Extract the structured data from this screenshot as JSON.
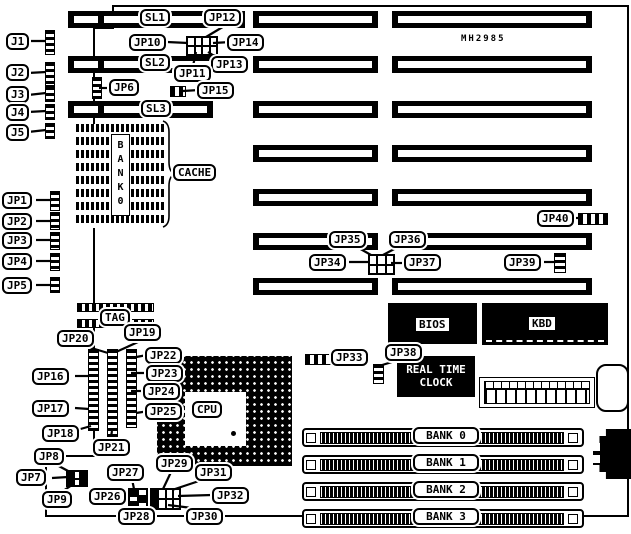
{
  "board": {
    "model": "MH2985"
  },
  "labels": {
    "j1": "J1",
    "j2": "J2",
    "j3": "J3",
    "j4": "J4",
    "j5": "J5",
    "jp1": "JP1",
    "jp2": "JP2",
    "jp3": "JP3",
    "jp4": "JP4",
    "jp5": "JP5",
    "jp6": "JP6",
    "jp7": "JP7",
    "jp8": "JP8",
    "jp9": "JP9",
    "jp10": "JP10",
    "jp11": "JP11",
    "jp12": "JP12",
    "jp13": "JP13",
    "jp14": "JP14",
    "jp15": "JP15",
    "jp16": "JP16",
    "jp17": "JP17",
    "jp18": "JP18",
    "jp19": "JP19",
    "jp20": "JP20",
    "jp21": "JP21",
    "jp22": "JP22",
    "jp23": "JP23",
    "jp24": "JP24",
    "jp25": "JP25",
    "jp26": "JP26",
    "jp27": "JP27",
    "jp28": "JP28",
    "jp29": "JP29",
    "jp30": "JP30",
    "jp31": "JP31",
    "jp32": "JP32",
    "jp33": "JP33",
    "jp34": "JP34",
    "jp35": "JP35",
    "jp36": "JP36",
    "jp37": "JP37",
    "jp38": "JP38",
    "jp39": "JP39",
    "jp40": "JP40",
    "sl1": "SL1",
    "sl2": "SL2",
    "sl3": "SL3",
    "tag": "TAG",
    "cpu": "CPU",
    "cache": "CACHE",
    "bios": "BIOS",
    "kbd": "KBD"
  },
  "rtc": {
    "line1": "REAL TIME",
    "line2": "CLOCK"
  },
  "cache_bank_vertical": "BANK0",
  "memory_banks": [
    "BANK 0",
    "BANK 1",
    "BANK 2",
    "BANK 3"
  ]
}
